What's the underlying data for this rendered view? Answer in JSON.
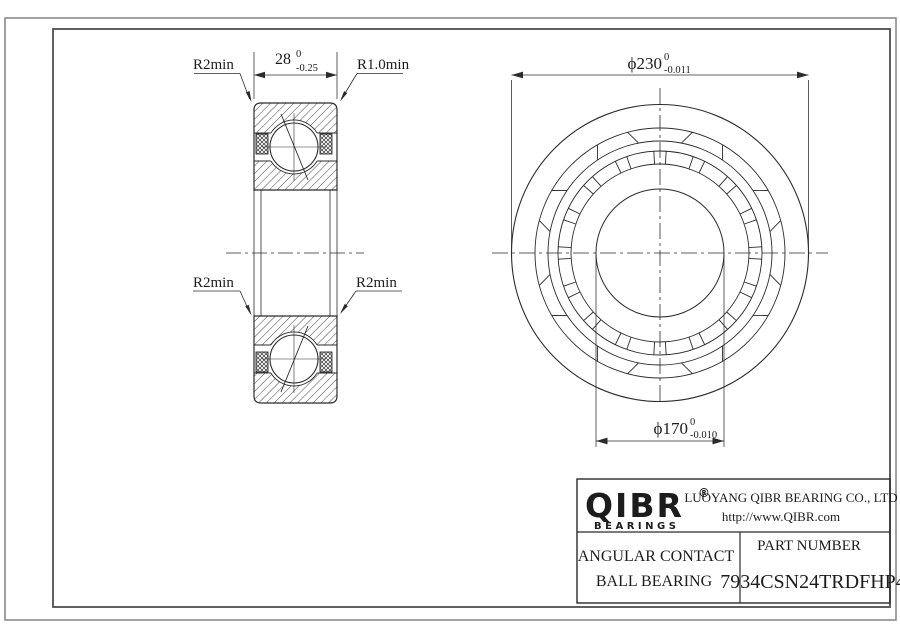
{
  "section_view": {
    "width_dim": {
      "value": "28",
      "tol_upper": "0",
      "tol_lower": "-0.25"
    },
    "radius_labels": {
      "top_left": "R2min",
      "top_right": "R1.0min",
      "bottom_left": "R2min",
      "bottom_right": "R2min"
    }
  },
  "front_view": {
    "outer_dim": {
      "value": "ϕ230",
      "tol_upper": "0",
      "tol_lower": "-0.011"
    },
    "bore_dim": {
      "value": "ϕ170",
      "tol_upper": "0",
      "tol_lower": "-0.010"
    }
  },
  "title_block": {
    "logo": {
      "text": "QIBR",
      "registered": "®",
      "subtitle": "BEARINGS"
    },
    "company": "LUOYANG QIBR BEARING CO., LTD",
    "website": "http://www.QIBR.com",
    "product": {
      "line1": "ANGULAR CONTACT",
      "line2": "BALL BEARING"
    },
    "part_number_label": "PART NUMBER",
    "part_number": "7934CSN24TRDFHP4"
  },
  "colors": {
    "line": "#2b2b2b",
    "frame": "#4f4f4f",
    "sheet_edge": "#8a8a8a",
    "background": "#ffffff"
  }
}
